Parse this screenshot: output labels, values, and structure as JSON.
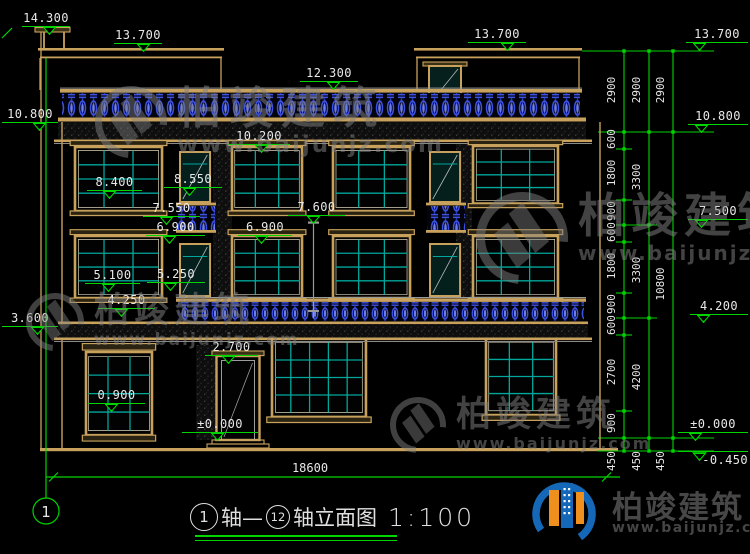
{
  "title_block": {
    "axis_bubble": "1",
    "start_axis": "1",
    "join": "轴—",
    "end_axis": "12",
    "name": "轴立面图",
    "scale": "1:100"
  },
  "elevations": {
    "e14300": "14.300",
    "e13700_left": "13.700",
    "e12300": "12.300",
    "e13700_tower": "13.700",
    "e13700_dim": "13.700",
    "e10800_left": "10.800",
    "e10800_right": "10.800",
    "e10200": "10.200",
    "e8550": "8.550",
    "e8400": "8.400",
    "e7600": "7.600",
    "e7550": "7.550",
    "e7500": "7.500",
    "e6900_left": "6.900",
    "e6900_right": "6.900",
    "e5250": "5.250",
    "e5100": "5.100",
    "e4250": "4.250",
    "e4200": "4.200",
    "e3600": "3.600",
    "e2700": "2.700",
    "e0900": "0.900",
    "e0000_entry": "±0.000",
    "e0000_right": "±0.000",
    "em0450": "-0.450"
  },
  "dimensions": {
    "overall_width": "18600",
    "chain_inner": [
      "2900",
      "600",
      "1800",
      "900",
      "600",
      "1800",
      "900",
      "600",
      "2700",
      "900",
      "450"
    ],
    "chain_middle": [
      "2900",
      "3300",
      "3300",
      "4200",
      "450"
    ],
    "chain_outer": [
      "2900",
      "10800",
      "450"
    ]
  },
  "watermark": {
    "name": "柏竣建筑",
    "url": "www.baijunjz.com"
  },
  "logo": {
    "name": "柏竣建筑",
    "url": "www.baijunjz.com"
  },
  "colors": {
    "background": "#000000",
    "dimension_green": "#00d500",
    "building_tan": "#c8a25c",
    "window_teal": "#00a79b",
    "baluster_blue": "#3d52e0",
    "text_white": "#e8e8e8"
  }
}
